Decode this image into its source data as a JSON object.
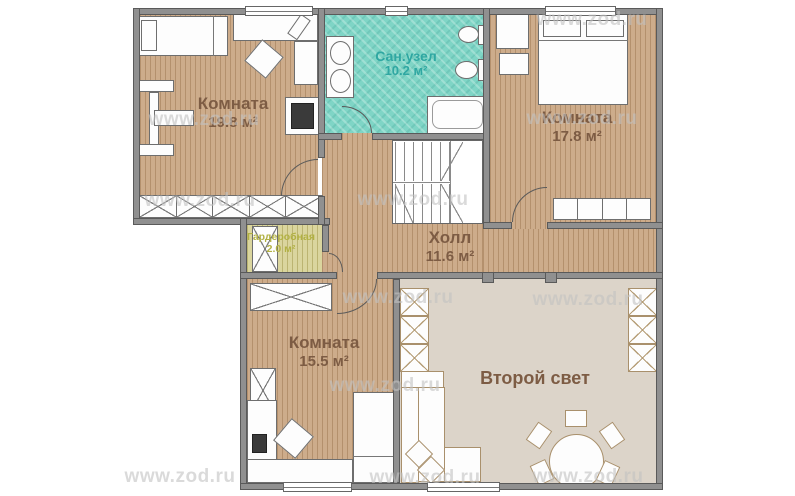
{
  "plan": {
    "watermark": "www.zod.ru",
    "rooms": [
      {
        "name": "Комната",
        "area": "19.8 м²"
      },
      {
        "name": "Сан.узел",
        "area": "10.2 м²"
      },
      {
        "name": "Комната",
        "area": "17.8 м²"
      },
      {
        "name": "Холл",
        "area": "11.6 м²"
      },
      {
        "name": "Гардеробная",
        "area": "2.0 м²"
      },
      {
        "name": "Комната",
        "area": "15.5 м²"
      },
      {
        "name": "Второй свет",
        "area": ""
      }
    ],
    "colors": {
      "wood_floor": "#cdac8b",
      "bath_tile": "#7fd5c6",
      "wardrobe_floor": "#dad59e",
      "void_floor": "#dcd4c9",
      "wall": "#909090",
      "room_label": "#7d5c44",
      "bath_label": "#2fa7a2",
      "wardrobe_label": "#b2b143",
      "watermark_color": "#c2c2c2"
    }
  }
}
